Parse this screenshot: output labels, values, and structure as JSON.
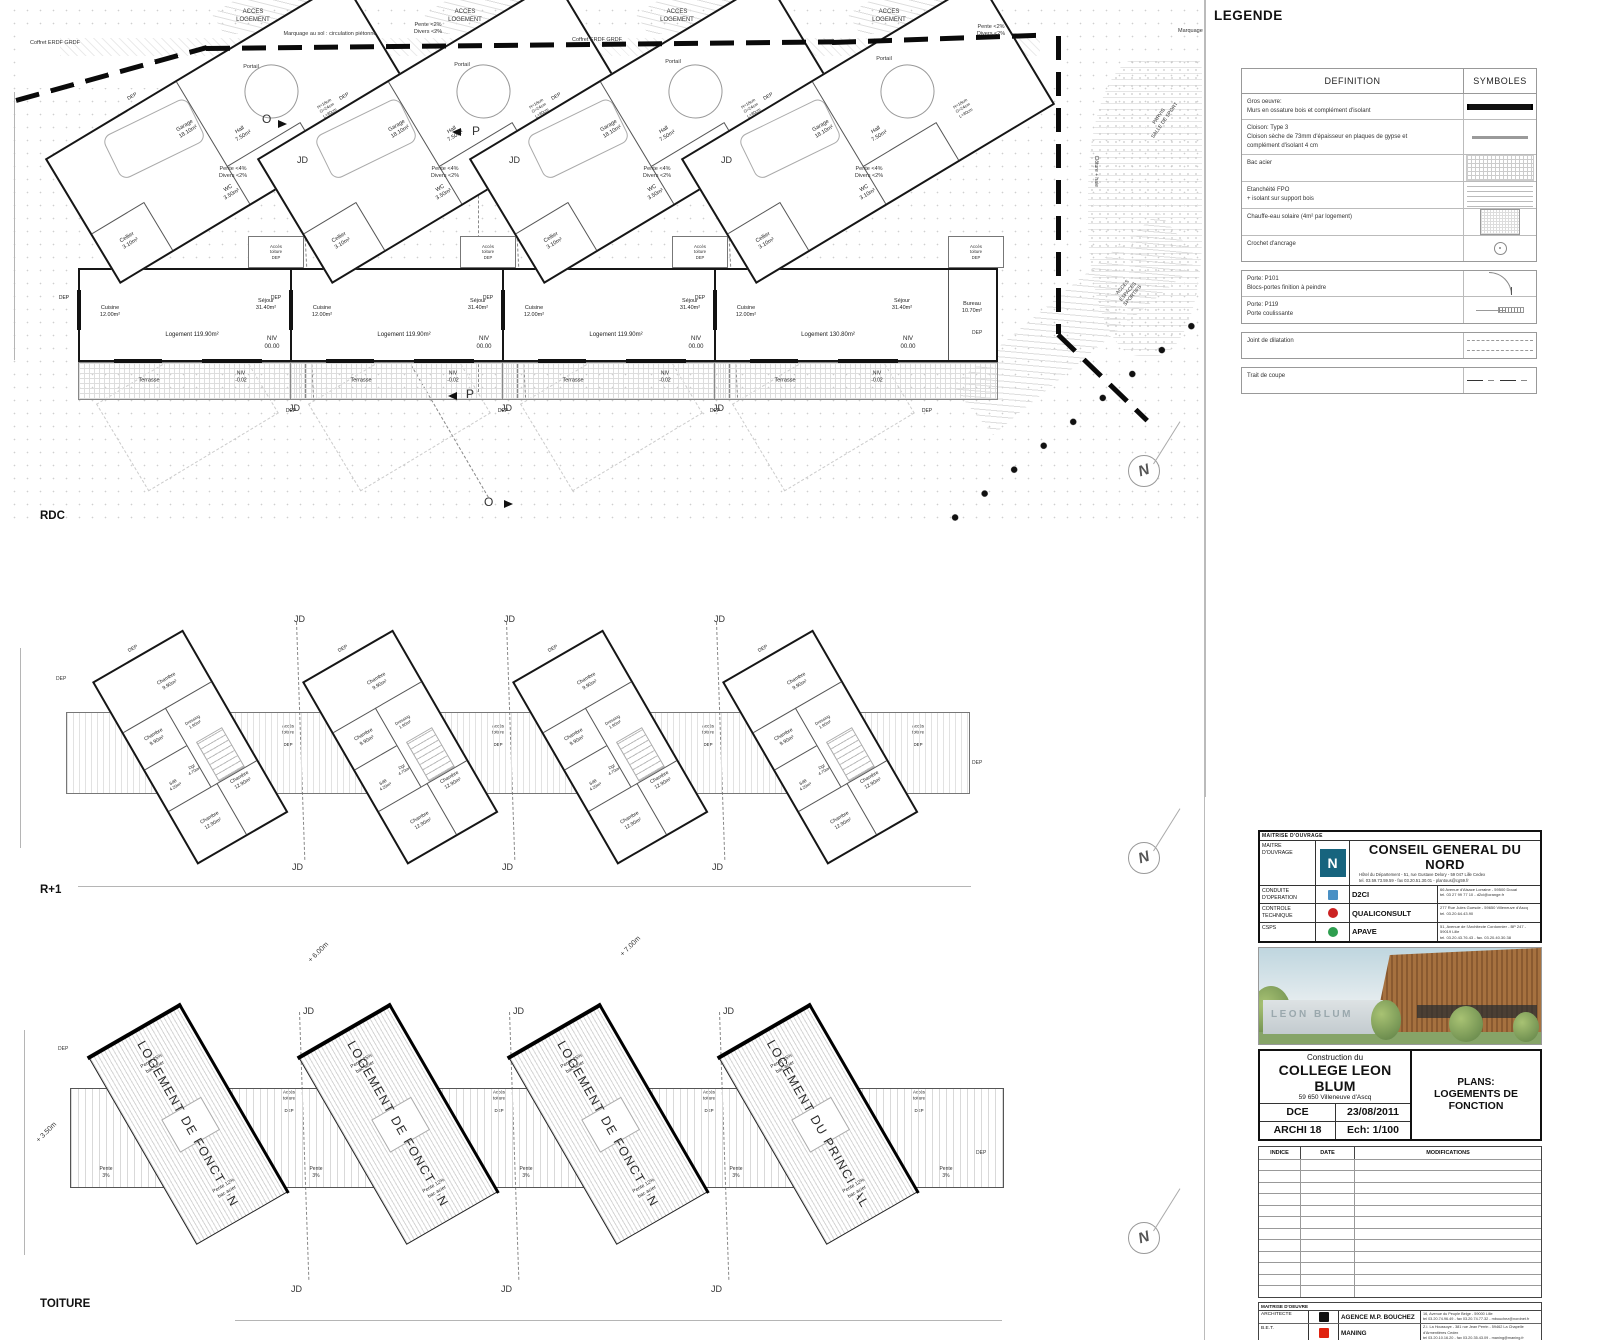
{
  "sheet": {
    "rdc_label": "RDC",
    "r1_label": "R+1",
    "toiture_label": "TOITURE",
    "north_letter": "N"
  },
  "rdc_units": [
    {
      "x": 62,
      "garage": "Garage\n18.10m²",
      "cellier": "Cellier\n3.10m²",
      "hall": "Hall\n7.50m²",
      "wc": "WC\n3.50m²",
      "stairs": "H=18cm\nG=24cm\nL=80cm",
      "cuisine": "Cuisine\n12.00m²",
      "sejour": "Séjour\n31.40m²",
      "logement": "Logement 119.90m²",
      "niv": "NIV\n00.00",
      "terrasse": "Terrasse",
      "niv_terrasse": "NIV\n-0.02",
      "acces": "Accès\ntoiture",
      "dep": "DEP",
      "bureau": ""
    },
    {
      "x": 274,
      "garage": "Garage\n18.10m²",
      "cellier": "Cellier\n3.10m²",
      "hall": "Hall\n7.50m²",
      "wc": "WC\n3.50m²",
      "stairs": "H=18cm\nG=24cm\nL=80cm",
      "cuisine": "Cuisine\n12.00m²",
      "sejour": "Séjour\n31.40m²",
      "logement": "Logement 119.90m²",
      "niv": "NIV\n00.00",
      "terrasse": "Terrasse",
      "niv_terrasse": "NIV\n-0.02",
      "acces": "Accès\ntoiture",
      "dep": "DEP",
      "bureau": ""
    },
    {
      "x": 486,
      "garage": "Garage\n18.10m²",
      "cellier": "Cellier\n3.10m²",
      "hall": "Hall\n7.50m²",
      "wc": "WC\n3.50m²",
      "stairs": "H=18cm\nG=24cm\nL=80cm",
      "cuisine": "Cuisine\n12.00m²",
      "sejour": "Séjour\n31.40m²",
      "logement": "Logement 119.90m²",
      "niv": "NIV\n00.00",
      "terrasse": "Terrasse",
      "niv_terrasse": "NIV\n-0.02",
      "acces": "Accès\ntoiture",
      "dep": "DEP",
      "bureau": ""
    },
    {
      "x": 698,
      "wide": true,
      "garage": "Garage\n18.10m²",
      "cellier": "Cellier\n3.10m²",
      "hall": "Hall\n7.50m²",
      "wc": "WC\n3.10m²",
      "stairs": "H=18cm\nG=24cm\nL=80cm",
      "cuisine": "Cuisine\n12.00m²",
      "sejour": "Séjour\n31.40m²",
      "logement": "Logement 130.80m²",
      "niv": "NIV\n00.00",
      "terrasse": "Terrasse",
      "niv_terrasse": "NIV\n-0.02",
      "acces": "Accès\ntoiture",
      "dep": "DEP",
      "bureau": "Bureau\n10.70m²"
    }
  ],
  "r1": {
    "x_positions": [
      70,
      280,
      490,
      700
    ],
    "labels": {
      "chambre_top": "Chambre\n9.90m²",
      "chambre_left": "Chambre\n9.90m²",
      "dressing": "Dressing\n1.90m²",
      "sdb": "SdB\n4.20m²",
      "dgt": "Dgt\n4.70m²",
      "chambre_bottom": "Chambre\n12.90m²",
      "chambre_right": "Chambre\n12.90m²",
      "acces": "Accès\ntoiture",
      "dep": "DEP"
    }
  },
  "toiture": {
    "common": {
      "pente25": "Pente 25%\nbac acier",
      "pente12": "Pente 12%\nbac acier",
      "acces": "Accès\ntoiture",
      "dep": "DEP"
    },
    "units": [
      {
        "x": 75,
        "label": "LOGEMENT DE FONCTION"
      },
      {
        "x": 285,
        "label": "LOGEMENT DE FONCTION"
      },
      {
        "x": 495,
        "label": "LOGEMENT DE FONCTION"
      },
      {
        "x": 705,
        "label": "LOGEMENT DU PRINCIPAL"
      }
    ]
  },
  "annotations": [
    {
      "name": "acces-logement-1",
      "text": "ACCES\nLOGEMENT",
      "x": 253,
      "y": 9,
      "ctr": true,
      "size": 6
    },
    {
      "name": "acces-logement-2",
      "text": "ACCES\nLOGEMENT",
      "x": 465,
      "y": 9,
      "ctr": true,
      "size": 6
    },
    {
      "name": "acces-logement-3",
      "text": "ACCES\nLOGEMENT",
      "x": 677,
      "y": 9,
      "ctr": true,
      "size": 6
    },
    {
      "name": "acces-logement-4",
      "text": "ACCES\nLOGEMENT",
      "x": 889,
      "y": 9,
      "ctr": true,
      "size": 6
    },
    {
      "name": "coffret-erdf-1",
      "text": "Coffret ERDF GRDF",
      "x": 30,
      "y": 40,
      "size": 5.5
    },
    {
      "name": "marquage-sol",
      "text": "Marquage au sol : circulation piétonne",
      "x": 330,
      "y": 31,
      "ctr": true,
      "size": 5.5
    },
    {
      "name": "pente-site-1",
      "text": "Pente <2%\nDivers <2%",
      "x": 428,
      "y": 22,
      "ctr": true,
      "size": 5.5
    },
    {
      "name": "coffret-erdf-2",
      "text": "Coffret ERDF GRDF",
      "x": 597,
      "y": 37,
      "ctr": true,
      "size": 5.5
    },
    {
      "name": "pente-site-2",
      "text": "Pente <2%\nDivers <2%",
      "x": 991,
      "y": 24,
      "ctr": true,
      "size": 5.5
    },
    {
      "name": "marquage-sol-2",
      "text": "Marquage",
      "x": 1178,
      "y": 28,
      "size": 5.5
    },
    {
      "name": "portail-1",
      "text": "Portail",
      "x": 251,
      "y": 64,
      "ctr": true,
      "size": 5.5
    },
    {
      "name": "portail-2",
      "text": "Portail",
      "x": 462,
      "y": 62,
      "ctr": true,
      "size": 5.5
    },
    {
      "name": "portail-3",
      "text": "Portail",
      "x": 673,
      "y": 59,
      "ctr": true,
      "size": 5.5
    },
    {
      "name": "portail-4",
      "text": "Portail",
      "x": 884,
      "y": 56,
      "ctr": true,
      "size": 5.5
    },
    {
      "name": "pente-unit-1",
      "text": "Pente <4%\nDivers <2%",
      "x": 233,
      "y": 166,
      "ctr": true,
      "size": 5.5
    },
    {
      "name": "pente-unit-2",
      "text": "Pente <4%\nDivers <2%",
      "x": 445,
      "y": 166,
      "ctr": true,
      "size": 5.5
    },
    {
      "name": "pente-unit-3",
      "text": "Pente <4%\nDivers <2%",
      "x": 657,
      "y": 166,
      "ctr": true,
      "size": 5.5
    },
    {
      "name": "pente-unit-4",
      "text": "Pente <4%\nDivers <2%",
      "x": 869,
      "y": 166,
      "ctr": true,
      "size": 5.5
    },
    {
      "name": "jd-rdc-top-1",
      "text": "JD",
      "x": 297,
      "y": 155,
      "size": 9
    },
    {
      "name": "jd-rdc-top-2",
      "text": "JD",
      "x": 509,
      "y": 155,
      "size": 9
    },
    {
      "name": "jd-rdc-top-3",
      "text": "JD",
      "x": 721,
      "y": 155,
      "size": 9
    },
    {
      "name": "jd-rdc-bot-1",
      "text": "JD",
      "x": 289,
      "y": 403,
      "size": 9
    },
    {
      "name": "jd-rdc-bot-2",
      "text": "JD",
      "x": 501,
      "y": 403,
      "size": 9
    },
    {
      "name": "jd-rdc-bot-3",
      "text": "JD",
      "x": 713,
      "y": 403,
      "size": 9
    },
    {
      "name": "section-o-top",
      "text": "O",
      "x": 262,
      "y": 112,
      "size": 12
    },
    {
      "name": "section-p-top",
      "text": "P",
      "x": 472,
      "y": 124,
      "size": 12
    },
    {
      "name": "section-p-bot",
      "text": "P",
      "x": 466,
      "y": 387,
      "size": 12
    },
    {
      "name": "section-o-bot",
      "text": "O",
      "x": 484,
      "y": 495,
      "size": 12
    },
    {
      "name": "parvis-label",
      "text": "PARVIS\nSALLE DE SPORT",
      "x": 1162,
      "y": 112,
      "ctr": true,
      "rot": -55,
      "size": 5
    },
    {
      "name": "acces-sportifs-label",
      "text": "ACCES\nESPACES\nSPORTIFS",
      "x": 1128,
      "y": 282,
      "ctr": true,
      "rot": -50,
      "size": 5
    },
    {
      "name": "cloture-label",
      "text": "Clôture + haie",
      "x": 1080,
      "y": 168,
      "rot": 90,
      "size": 5
    },
    {
      "name": "dep-rdc-extra-1",
      "text": "DEP",
      "x": 972,
      "y": 330,
      "size": 5
    },
    {
      "name": "jd-r1-top-1",
      "text": "JD",
      "x": 294,
      "y": 614,
      "size": 9
    },
    {
      "name": "jd-r1-top-2",
      "text": "JD",
      "x": 504,
      "y": 614,
      "size": 9
    },
    {
      "name": "jd-r1-top-3",
      "text": "JD",
      "x": 714,
      "y": 614,
      "size": 9
    },
    {
      "name": "jd-r1-bot-1",
      "text": "JD",
      "x": 292,
      "y": 862,
      "size": 9
    },
    {
      "name": "jd-r1-bot-2",
      "text": "JD",
      "x": 502,
      "y": 862,
      "size": 9
    },
    {
      "name": "jd-r1-bot-3",
      "text": "JD",
      "x": 712,
      "y": 862,
      "size": 9
    },
    {
      "name": "dep-r1-left",
      "text": "DEP",
      "x": 56,
      "y": 676,
      "size": 5
    },
    {
      "name": "dep-r1-right",
      "text": "DEP",
      "x": 972,
      "y": 760,
      "size": 5
    },
    {
      "name": "jd-toit-top-1",
      "text": "JD",
      "x": 303,
      "y": 1006,
      "size": 9
    },
    {
      "name": "jd-toit-top-2",
      "text": "JD",
      "x": 513,
      "y": 1006,
      "size": 9
    },
    {
      "name": "jd-toit-top-3",
      "text": "JD",
      "x": 723,
      "y": 1006,
      "size": 9
    },
    {
      "name": "jd-toit-bot-1",
      "text": "JD",
      "x": 291,
      "y": 1284,
      "size": 9
    },
    {
      "name": "jd-toit-bot-2",
      "text": "JD",
      "x": 501,
      "y": 1284,
      "size": 9
    },
    {
      "name": "jd-toit-bot-3",
      "text": "JD",
      "x": 711,
      "y": 1284,
      "size": 9
    },
    {
      "name": "height-350",
      "text": "+ 3.50m",
      "x": 34,
      "y": 1128,
      "rot": -45,
      "size": 7
    },
    {
      "name": "height-600",
      "text": "+ 6.00m",
      "x": 306,
      "y": 948,
      "rot": -45,
      "size": 7
    },
    {
      "name": "height-700",
      "text": "+ 7.00m",
      "x": 618,
      "y": 942,
      "rot": -45,
      "size": 7
    },
    {
      "name": "pente3-1",
      "text": "Pente\n3%",
      "x": 106,
      "y": 1166,
      "ctr": true,
      "size": 5
    },
    {
      "name": "pente3-2",
      "text": "Pente\n3%",
      "x": 316,
      "y": 1166,
      "ctr": true,
      "size": 5
    },
    {
      "name": "pente3-3",
      "text": "Pente\n3%",
      "x": 526,
      "y": 1166,
      "ctr": true,
      "size": 5
    },
    {
      "name": "pente3-4",
      "text": "Pente\n3%",
      "x": 736,
      "y": 1166,
      "ctr": true,
      "size": 5
    },
    {
      "name": "pente3-5",
      "text": "Pente\n3%",
      "x": 946,
      "y": 1166,
      "ctr": true,
      "size": 5
    },
    {
      "name": "dep-toit-left",
      "text": "DEP",
      "x": 58,
      "y": 1046,
      "size": 5
    },
    {
      "name": "dep-toit-right",
      "text": "DEP",
      "x": 976,
      "y": 1150,
      "size": 5
    }
  ],
  "legend": {
    "title": "LEGENDE",
    "col_definition": "DEFINITION",
    "col_symboles": "SYMBOLES",
    "rows": [
      {
        "box": 0,
        "sym": "wall",
        "def": "Gros oeuvre:\nMurs en ossature bois et complément d'isolant"
      },
      {
        "box": 0,
        "sym": "partition",
        "def": "Cloison: Type 3\nCloison sèche de 73mm d'épaisseur en plaques de gypse et\ncomplément d'isolant 4 cm"
      },
      {
        "box": 0,
        "sym": "grid",
        "def": "Bac acier"
      },
      {
        "box": 0,
        "sym": "hlines",
        "def": "Etanchéité FPO\n+ isolant sur support bois"
      },
      {
        "box": 0,
        "sym": "panel",
        "def": "Chauffe-eau solaire (4m² par logement)"
      },
      {
        "box": 0,
        "sym": "hook",
        "def": "Crochet d'ancrage"
      },
      {
        "box": 1,
        "sym": "door",
        "def": "Porte: P101\nBlocs-portes finition à peindre"
      },
      {
        "box": 1,
        "sym": "sliding",
        "def": "Porte: P119\nPorte coulissante"
      },
      {
        "box": 2,
        "sym": "joint",
        "def": "Joint de dilatation"
      },
      {
        "box": 3,
        "sym": "cut",
        "def": "Trait de coupe"
      }
    ]
  },
  "titleblock": {
    "ouvrage_header": "MAITRISE D'OUVRAGE",
    "maitre_label": "MAITRE\nD'OUVRAGE",
    "maitre_logo_letter": "N",
    "maitre_name": "CONSEIL GENERAL DU NORD",
    "maitre_addr": "Hôtel du Département - 51, rue Gustave Delory - 59 047 Lille Cedex\ntel. 03.59.73.59.59 - fax 03.20.51.30.01 - plantous@cg59.fr",
    "ouvrage_rows": [
      {
        "role": "CONDUITE\nD'OPERATION",
        "firm": "D2CI",
        "logo": "#4a90c4",
        "shape": "sq",
        "addr": "66 Avenue d'Alsace Lorraine - 59500 Douai\ntel. 03 27 99 77 10 - d2ci@orange.fr"
      },
      {
        "role": "CONTROLE\nTECHNIQUE",
        "firm": "QUALICONSULT",
        "logo": "#cc2222",
        "shape": "dot",
        "addr": "277 Rue Jules Guesde - 59650 Villeneuve d'Ascq\ntel. 03.20.64.43.90"
      },
      {
        "role": "CSPS",
        "firm": "APAVE",
        "logo": "#2e9e4f",
        "shape": "dot",
        "addr": "51, Avenue de l'Architecte Cordonnier - BP 247 - 59019 Lille\ntel. 03.20.43.76.43 - fax. 03.20.40.30.38"
      }
    ],
    "rendering_text": "LEON BLUM",
    "project_line1": "Construction du",
    "project_line2": "COLLEGE LEON BLUM",
    "project_line3": "59 650 Villeneuve d'Ascq",
    "phase": "DCE",
    "date": "23/08/2011",
    "doc_no": "ARCHI 18",
    "scale": "Ech:  1/100",
    "plans_line1": "PLANS:",
    "plans_line2": "LOGEMENTS DE FONCTION",
    "indice_headers": [
      "INDICE",
      "DATE",
      "MODIFICATIONS"
    ],
    "oeuvre_header": "MAITRISE D'OEUVRE",
    "oeuvre_rows": [
      {
        "role": "ARCHITECTE",
        "firm": "AGENCE M.P. BOUCHEZ",
        "logo": "#111111",
        "shape": "sq",
        "addr": "16, Avenue du Peuple Belge - 59000 Lille\ntel 03.20.74.96.49 - fax 03.20.74.77.32 - mbouchez@nordnet.fr"
      },
      {
        "role": "B.E.T.",
        "firm": "MANING",
        "logo": "#e02310",
        "shape": "sq",
        "addr": "Z.I. La Houssoye - 381 rue Jean Perrin - 59462 La Chapelle d'Armentières Cedex\ntel 03.20.10.16.20 - fax 03.20.35.43.09 - maning@maning.fr"
      },
      {
        "role": "B.E.T. HQE",
        "firm": "ADDENDA",
        "logo": "#d2a24c",
        "shape": "sq",
        "addr": "RN d'Auch - 32550 Mirande\ntel 05.62.66.82.56 - fax 05.62.66.82.51 - am@addenda.fr"
      },
      {
        "role": "ECONOMISTE",
        "firm": "RPO",
        "logo": "#1b4ea0",
        "shape": "sq",
        "addr": "7 rue Armand Moisant 75015 PARIS\ntel 01.42.79.19.99 - fax 01.42.79.19.42 - dany.marche@rpo.fr"
      },
      {
        "role": "PAYSAGISTE",
        "firm": "S. DUVAL",
        "logo": "#7fae86",
        "shape": "sq",
        "addr": "380 avenue Marc Lefrancq - 59300 Valenciennes\ntel 03.27.33.84.52 - fax 03.27.33.26.31 - sylvaine.williams@orange.fr"
      }
    ]
  }
}
